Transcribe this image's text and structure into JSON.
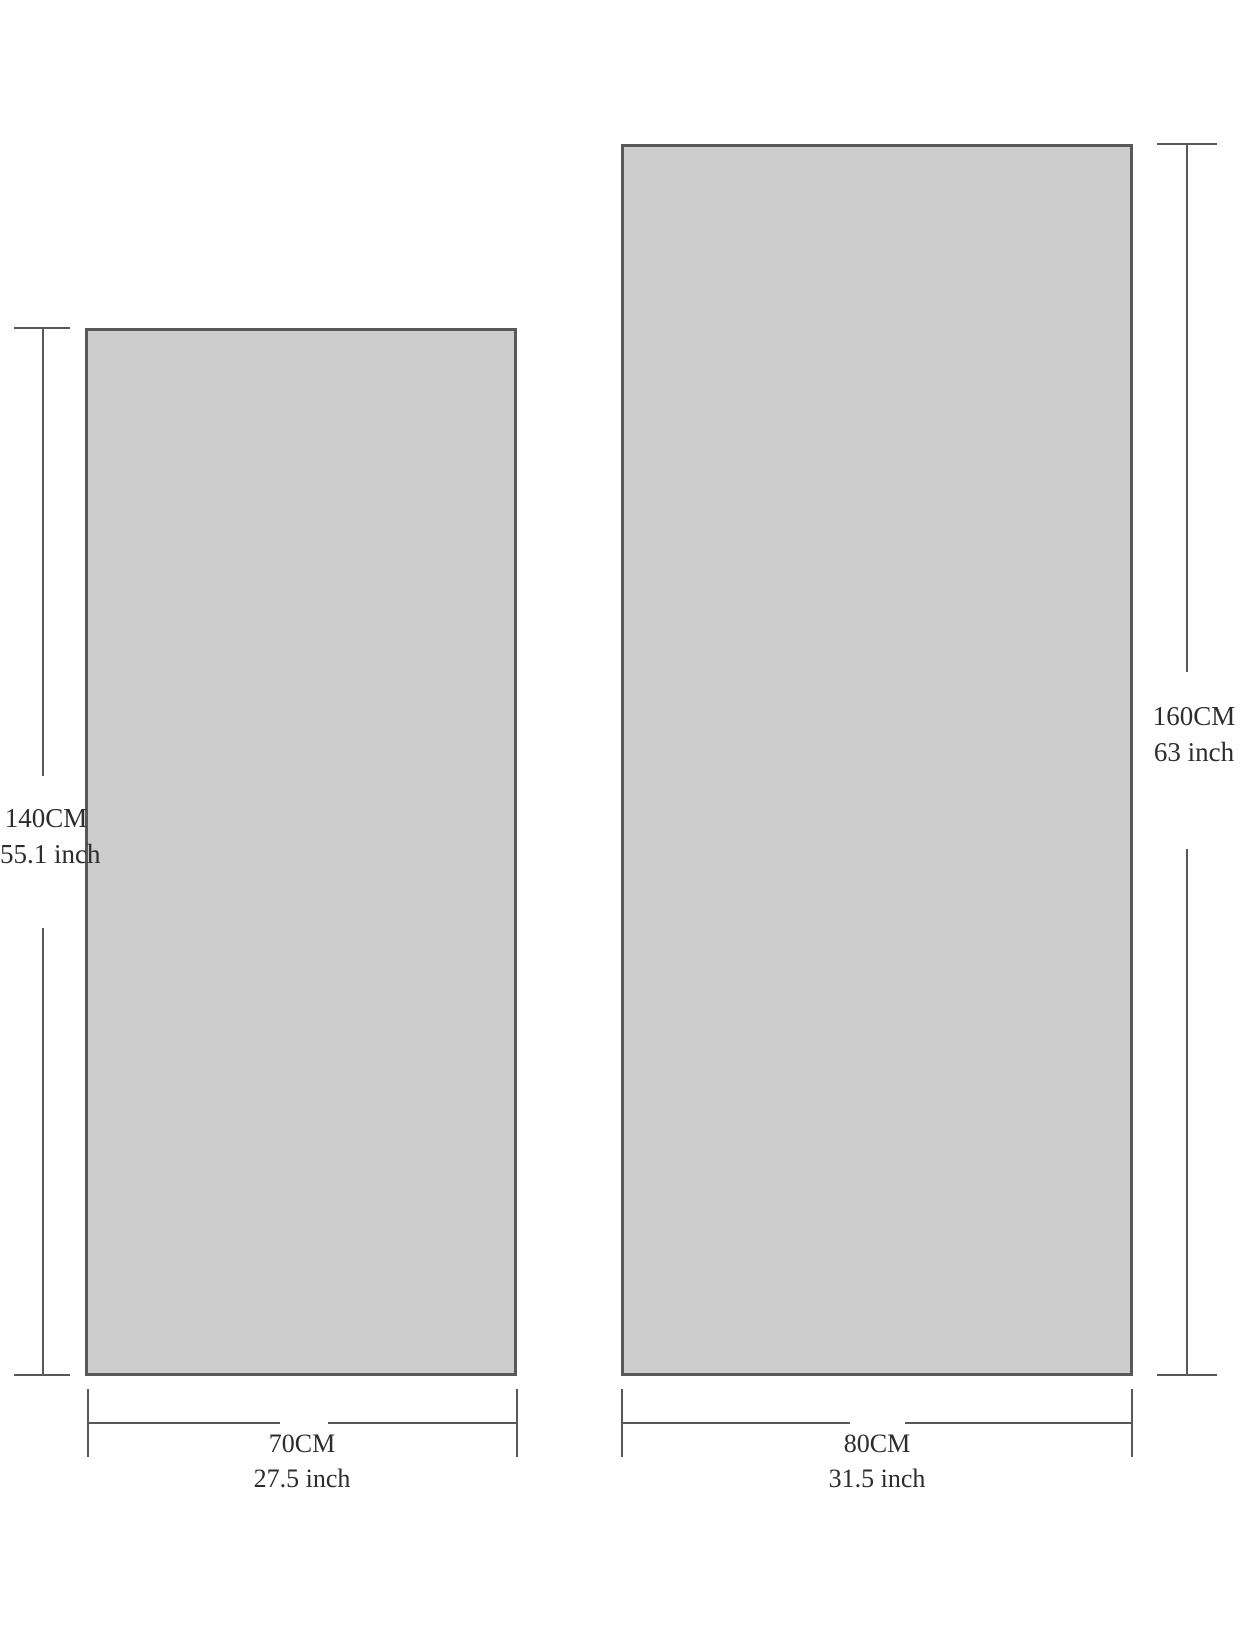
{
  "items": {
    "small": {
      "height_cm": "140CM",
      "height_inch": "55.1 inch",
      "width_cm": "70CM",
      "width_inch": "27.5 inch"
    },
    "large": {
      "height_cm": "160CM",
      "height_inch": "63 inch",
      "width_cm": "80CM",
      "width_inch": "31.5 inch"
    }
  },
  "colors": {
    "rect_fill": "#cccccc",
    "line": "#58585a",
    "text": "#2d2d2f",
    "background": "#ffffff"
  }
}
